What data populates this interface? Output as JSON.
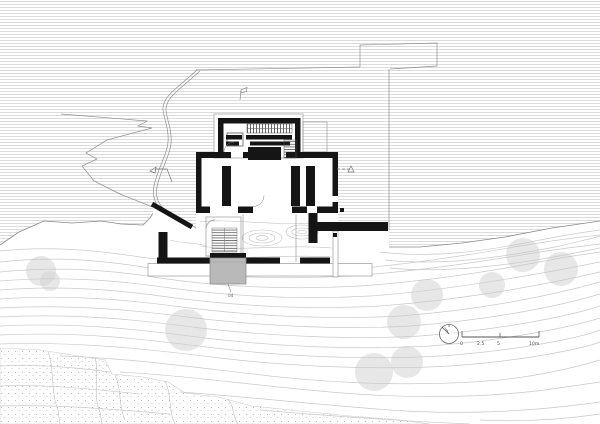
{
  "drawing": {
    "scale_bar": {
      "labels": [
        "0",
        "2.5",
        "5",
        "10m"
      ]
    },
    "labels": {
      "stair": "04"
    },
    "colors": {
      "wall": "#151515",
      "hatch_line": "#dcdcdc",
      "contour": "#c9c9c9",
      "site_line": "#8f8f8f",
      "tree": "#d4d4d4",
      "external_stair": "#b9b9b9",
      "stipple": "#a8a8a8"
    }
  }
}
